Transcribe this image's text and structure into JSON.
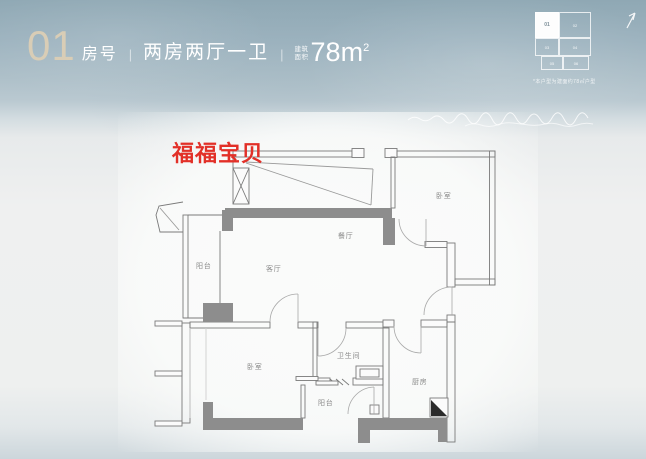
{
  "header": {
    "unit_number": "01",
    "unit_number_label": "房号",
    "divider": "|",
    "layout_type": "两房两厅一卫",
    "area_label_line1": "建筑",
    "area_label_line2": "面积",
    "area_value": "78m",
    "area_superscript": "2",
    "keyplan": {
      "note": "*本户型为建面约78㎡户型",
      "highlighted_unit": "01",
      "units": [
        "01",
        "02",
        "03",
        "04",
        "05",
        "06"
      ]
    }
  },
  "watermark": {
    "text": "福福宝贝",
    "color": "#e23028"
  },
  "floorplan": {
    "rooms": [
      {
        "name": "阳台"
      },
      {
        "name": "客厅"
      },
      {
        "name": "餐厅"
      },
      {
        "name": "卧室"
      },
      {
        "name": "卧室"
      },
      {
        "name": "卫生间"
      },
      {
        "name": "阳台"
      },
      {
        "name": "厨房"
      }
    ]
  },
  "colors": {
    "accent_tan": "#d9cdb6",
    "header_background": "#9db3bf",
    "header_text": "#ffffff",
    "wall_gray": "#8d8d8d",
    "line_gray": "#7a7a7a",
    "label_gray": "#8a8a8a",
    "watermark_red": "#e23028"
  }
}
